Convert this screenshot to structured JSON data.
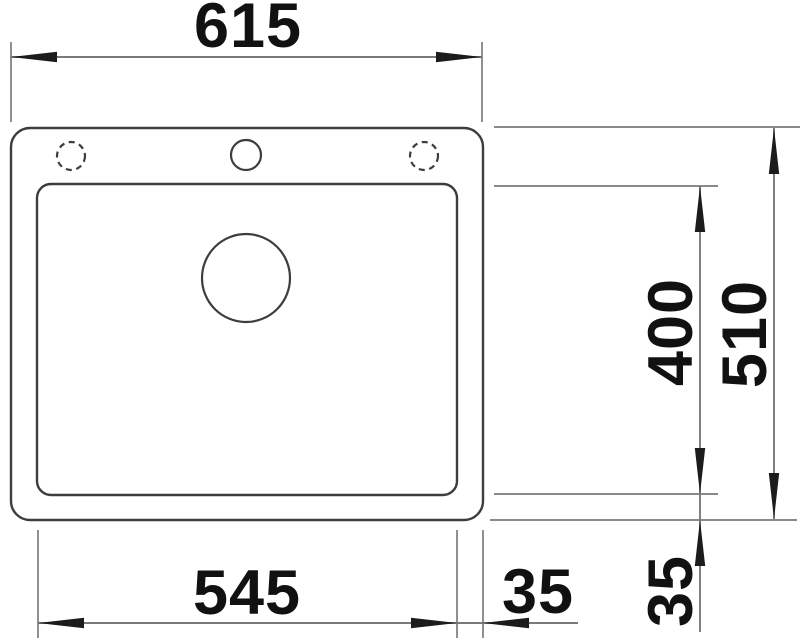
{
  "drawing": {
    "kind": "technical-dimension-drawing",
    "subject": "inset kitchen sink with single bowl, plan view"
  },
  "dimensions": {
    "overall_width": "615",
    "overall_depth": "510",
    "bowl_width": "545",
    "bowl_depth": "400",
    "bowl_to_edge_vertical": "35",
    "bowl_to_edge_horizontal": "35"
  },
  "features": {
    "tap_hole_center": "drilled tap hole (solid circle)",
    "tap_hole_left": "optional tap hole (dashed circle)",
    "tap_hole_right": "optional tap hole (dashed circle)",
    "drain": "drain / waste outlet circle"
  },
  "colors": {
    "background": "#ffffff",
    "outline": "#3d3d3d",
    "dimension_lines": "#7a7a7a",
    "extension_lines": "#8a8a8a",
    "arrowheads": "#1c1c1c",
    "text": "#111111"
  }
}
